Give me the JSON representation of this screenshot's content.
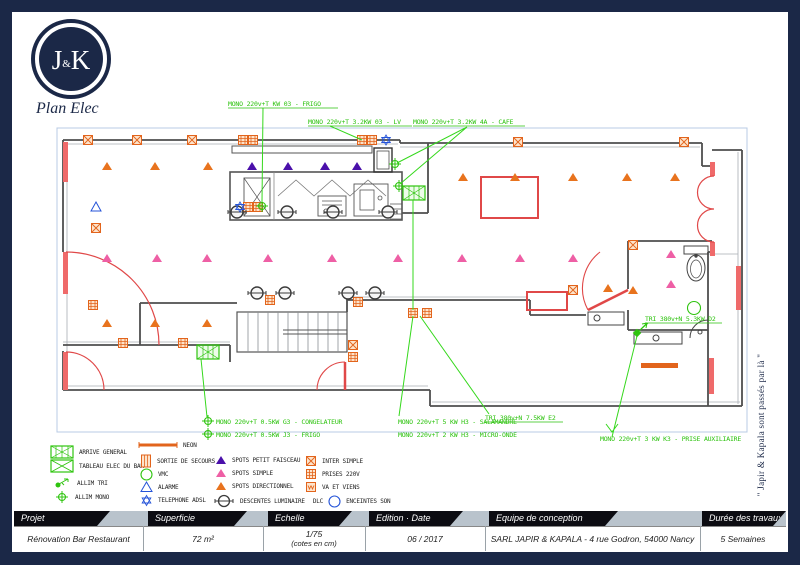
{
  "logo": {
    "j": "J",
    "amp": "&",
    "k": "K",
    "subtitle": "Plan Elec"
  },
  "watermark": "\" Japir & Kapala sont passés par là \"",
  "plan": {
    "ann": {
      "a1": "MONO 220v+T   KW 03 - FRIGO",
      "a2": "MONO 220v+T  3.2KW 03 - LV",
      "a3": "MONO 220v+T  3.2KW 4A - CAFE",
      "a4": "MONO 220v+T  0.5KW G3 - CONGELATEUR",
      "a5": "MONO 220v+T  0.5KW J3 - FRIGO",
      "a6": "MONO 220v+T  5 KW H3 - SALAMANDRE",
      "a7": "MONO 220v+T  2 KW H3 - MICRO-ONDE",
      "a8": "TRI 380v+N  7.5KW E2",
      "a9": "MONO 220v+T  3 KW K3 - PRISE AUXILIAIRE",
      "a10": "TRI 380v+N  5.3KW D2"
    }
  },
  "legend": {
    "arrive_general": "ARRIVE GENERAL",
    "tableau": "TABLEAU ELEC DU BAR",
    "allim_tri": "ALLIM TRI",
    "allim_mono": "ALLIM MONO",
    "neon": "NEON",
    "sortie": "SORTIE DE SECOURS",
    "vmc": "VMC",
    "alarme": "ALARME",
    "adsl": "TELEPHONE ADSL",
    "spots_petit": "SPOTS PETIT FAISCEAU",
    "spots_simple": "SPOTS SIMPLE",
    "spots_dir": "SPOTS DIRECTIONNEL",
    "descentes": "DESCENTES LUMINAIRE",
    "dlc_tag": "DLC",
    "inter": "INTER SIMPLE",
    "prises": "PRISES 220V",
    "vaviens": "VA ET VIENS",
    "enceintes": "ENCEINTES SON"
  },
  "titleblock": {
    "h1": "Projet",
    "v1": "Rénovation Bar Restaurant",
    "h2": "Superficie",
    "v2": "72  m²",
    "h3": "Echelle",
    "v3a": "1/75",
    "v3b": "(cotes en cm)",
    "h4": "Edition · Date",
    "v4": "06 / 2017",
    "h5": "Equipe de conception",
    "v5": "SARL JAPIR & KAPALA - 4 rue Godron, 54000 Nancy",
    "h6": "Durée des travaux",
    "v6": "5 Semaines"
  },
  "colors": {
    "navy": "#1b2847",
    "green": "#2fc40f",
    "orange": "#e2641c",
    "pink": "#ee5fa5",
    "purple": "#4a10aa",
    "red": "#e04848",
    "blue": "#2453d8",
    "wall": "#4f4f4f",
    "band": "#b9c3cc"
  }
}
